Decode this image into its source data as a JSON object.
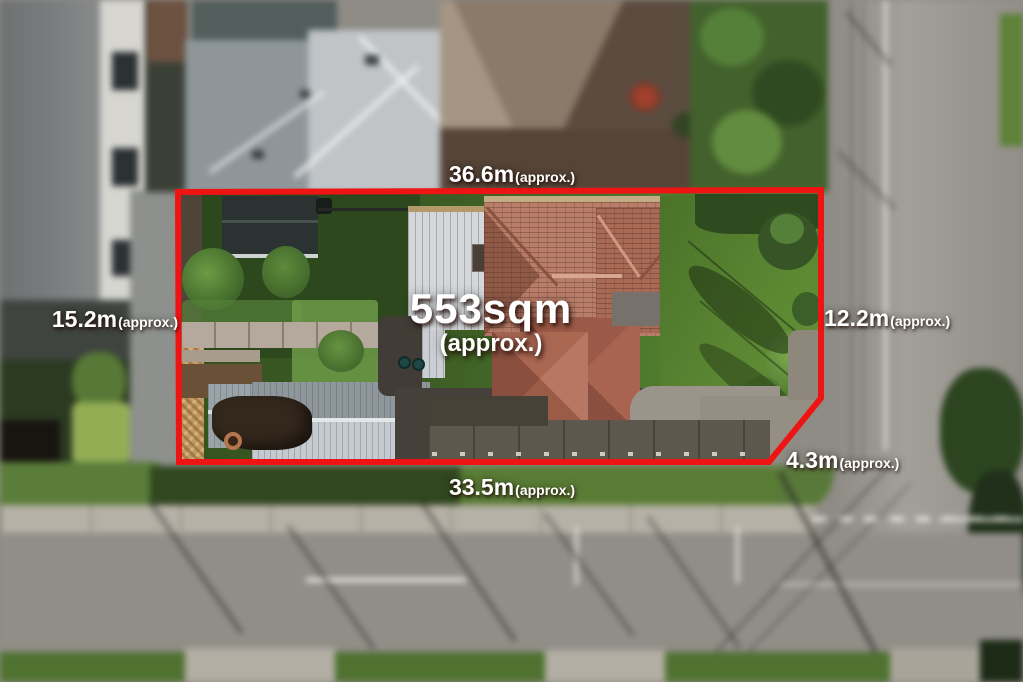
{
  "annotations": {
    "boundary_color": "#ee1414",
    "label_color": "#ffffff",
    "area": {
      "value": "553sqm",
      "approx": "(approx.)"
    },
    "measurements": [
      {
        "side": "top",
        "value": "36.6m",
        "approx": "(approx.)"
      },
      {
        "side": "left",
        "value": "15.2m",
        "approx": "(approx.)"
      },
      {
        "side": "right",
        "value": "12.2m",
        "approx": "(approx.)"
      },
      {
        "side": "bottom",
        "value": "33.5m",
        "approx": "(approx.)"
      },
      {
        "side": "bottom-right",
        "value": "4.3m",
        "approx": "(approx.)"
      }
    ]
  }
}
